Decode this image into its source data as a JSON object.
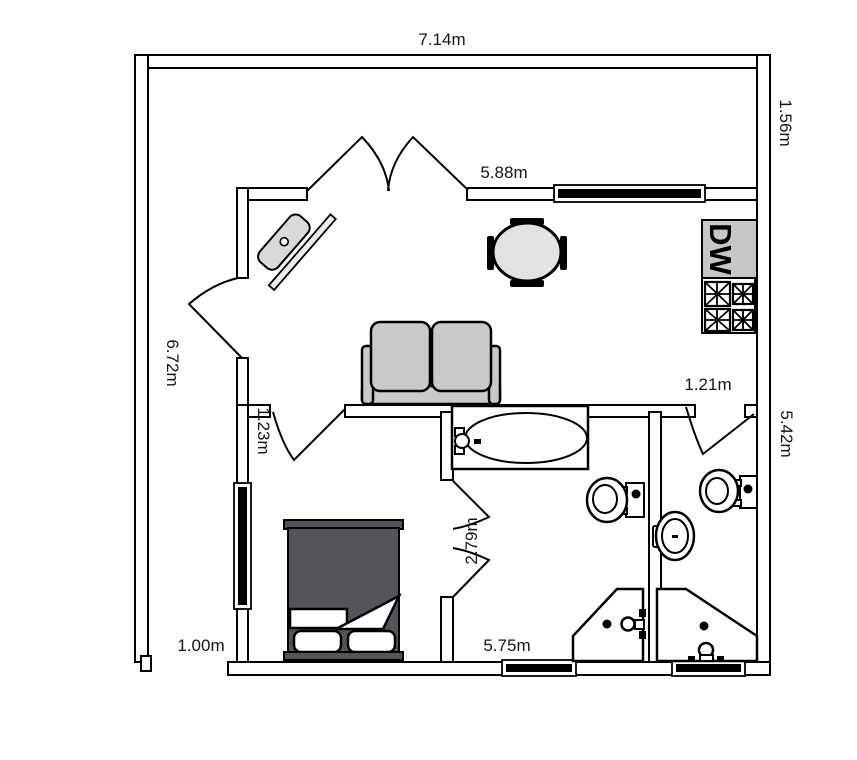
{
  "title": "apartment-floor-plan",
  "labels": {
    "top_width": "7.14m",
    "top_strip_depth": "1.56m",
    "living_room_width": "5.88m",
    "left_height": "6.72m",
    "wc_door_width": "1.21m",
    "right_height": "5.42m",
    "bedroom_door_width": "1.23m",
    "hall_width": "2.79m",
    "left_strip_width": "1.00m",
    "bottom_width": "5.75m"
  },
  "appliances": {
    "dishwasher_label": "DW"
  },
  "colors": {
    "line": "#000000",
    "furniture_gray": "#c9c9c9",
    "table_gray": "#e2e2e2",
    "bed_dark": "#54545a",
    "appliance_gray": "#c6c6c6"
  }
}
